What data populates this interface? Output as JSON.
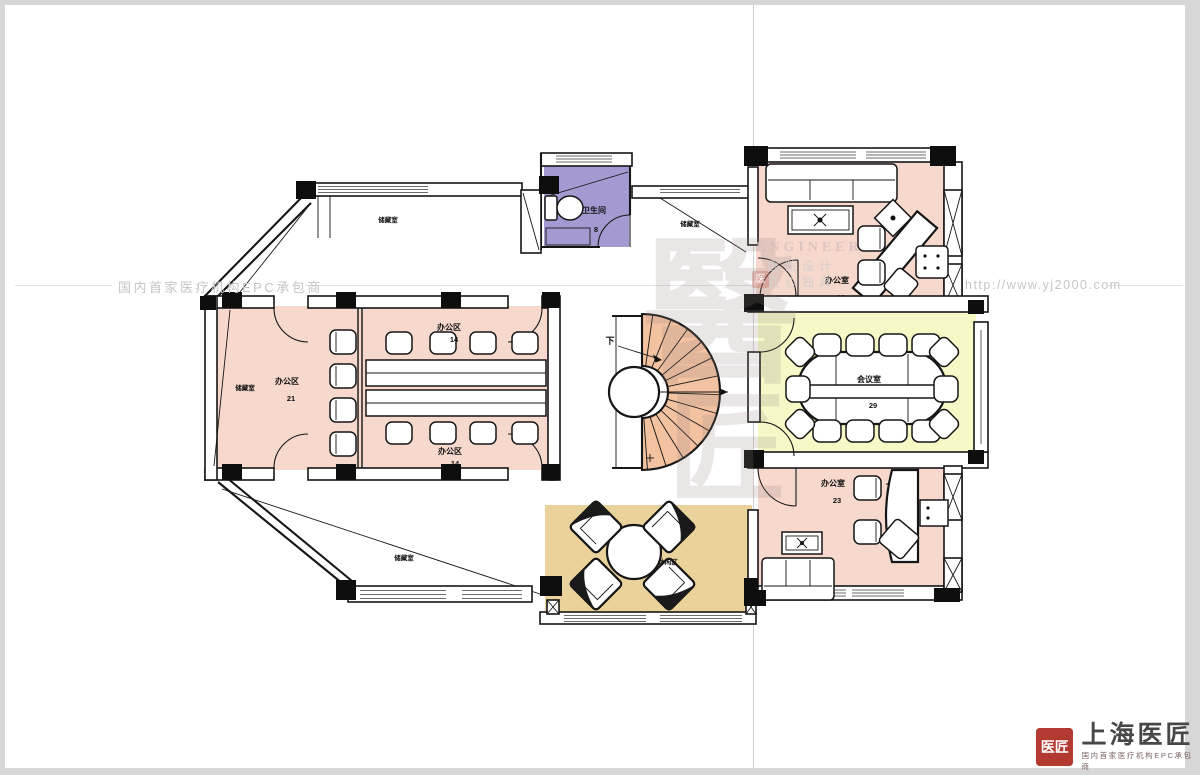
{
  "watermarks": {
    "left_tagline": "国内首家医疗机构EPC承包商",
    "url": "http://www.yj2000.com",
    "seal_top": "醫",
    "seal_bottom": "匠",
    "engineer": "ENGINEER",
    "design": "医院设计",
    "motto": "匠心独具",
    "mini_seal": "医"
  },
  "logo": {
    "seal": "医匠",
    "name": "上海医匠",
    "tagline": "国内首家医疗机构EPC承包商"
  },
  "rooms": {
    "bathroom": {
      "label": "卫生间",
      "area": "8"
    },
    "office_left": {
      "label": "办公区",
      "area": "21"
    },
    "open_office_top": {
      "label": "办公区",
      "area": "14"
    },
    "open_office_bottom": {
      "label": "办公区",
      "area": "14"
    },
    "exec_office_top": {
      "label": "办公室",
      "area": "23"
    },
    "meeting_room": {
      "label": "会议室",
      "area": "29"
    },
    "exec_office_bottom": {
      "label": "办公室",
      "area": "23"
    },
    "leisure": {
      "label": "休闲区"
    },
    "storage_a": "储藏室",
    "storage_b": "储藏室",
    "storage_c": "储藏室",
    "storage_d": "储藏室",
    "stair_down": "下"
  },
  "colors": {
    "pink": "#f7d8cc",
    "purple": "#a49ad1",
    "yellow": "#f6f8c6",
    "tan": "#e9d29b",
    "stair": "#f3c2a0",
    "wall": "#161616",
    "watermark_gray": "#c5c5c5",
    "logo_red": "#b23a30"
  }
}
